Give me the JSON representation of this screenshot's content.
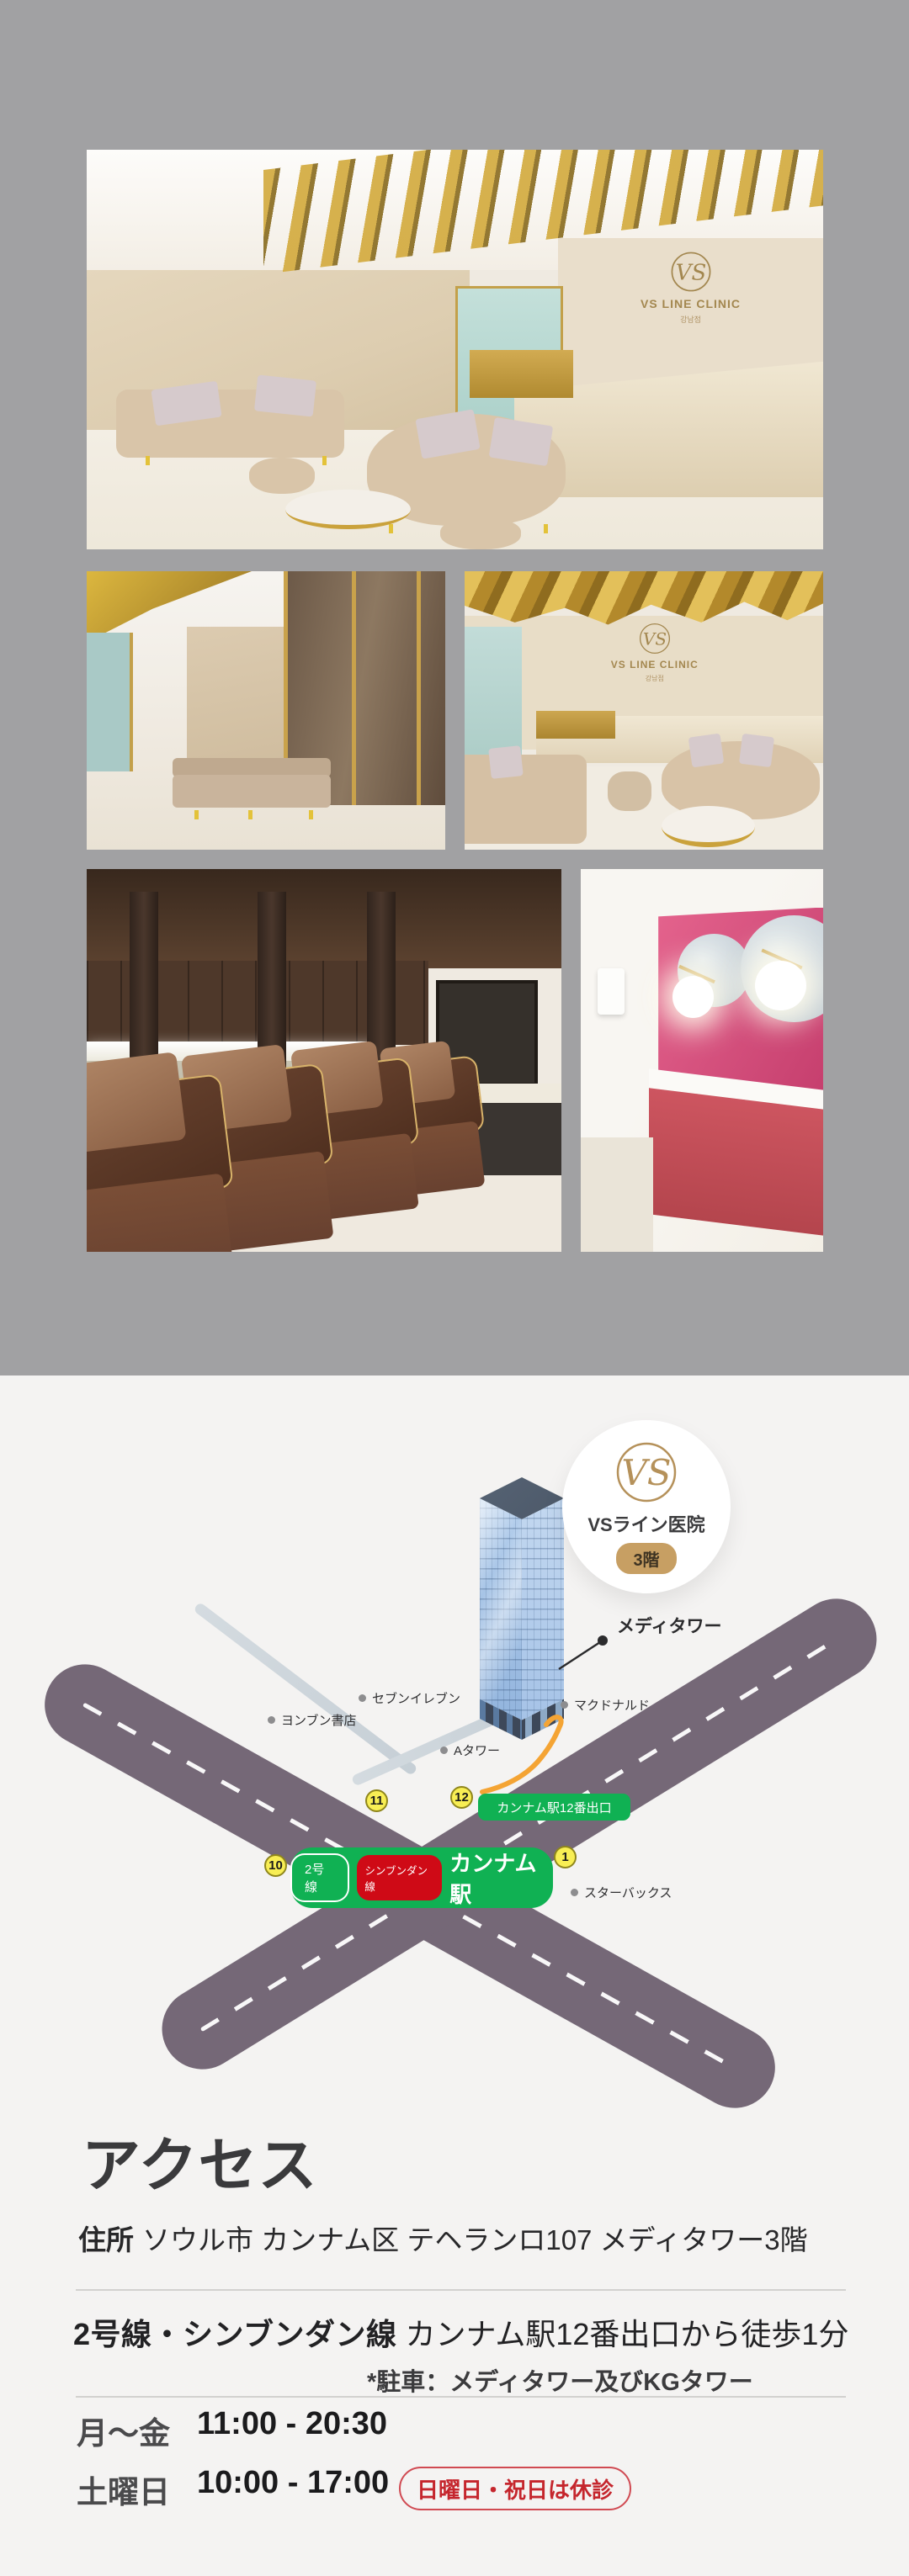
{
  "gallery": {
    "wall_brand": "VS LINE CLINIC",
    "wall_brand_sub": "강남점",
    "logo_initials": "VS"
  },
  "map": {
    "badge": {
      "logo_initials": "VS",
      "name": "VSライン医院",
      "floor": "3階"
    },
    "tower_label": "メディタワー",
    "landmarks": [
      {
        "text": "セブンイレブン"
      },
      {
        "text": "ヨンブン書店"
      },
      {
        "text": "Aタワー"
      },
      {
        "text": "マクドナルド"
      },
      {
        "text": "スターバックス"
      }
    ],
    "exits": [
      {
        "n": "11"
      },
      {
        "n": "12"
      },
      {
        "n": "10"
      },
      {
        "n": "1"
      }
    ],
    "exit_badge": "カンナム駅12番出口",
    "station": {
      "line2": "2号線",
      "shinbundang": "シンブンダン線",
      "name": "カンナム駅"
    },
    "colors": {
      "road": "#756877",
      "green": "#10b153",
      "red": "#cf0a16",
      "exit_yellow": "#f8ee54",
      "path_orange": "#f4a434",
      "badge_tan": "#c79f63",
      "building_blue": "#9cbde4"
    }
  },
  "access": {
    "title": "アクセス",
    "address_label": "住所",
    "address": "ソウル市 カンナム区 テヘランロ107 メディタワー3階",
    "route_bold": "2号線・シンブンダン線",
    "route_rest": "カンナム駅12番出口から徒歩1分",
    "parking_note": "*駐車：メディタワー及びKGタワー",
    "hours": [
      {
        "day": "月〜金",
        "time": "11:00 - 20:30"
      },
      {
        "day": "土曜日",
        "time": "10:00 - 17:00"
      }
    ],
    "closed_badge": "日曜日・祝日は休診"
  }
}
